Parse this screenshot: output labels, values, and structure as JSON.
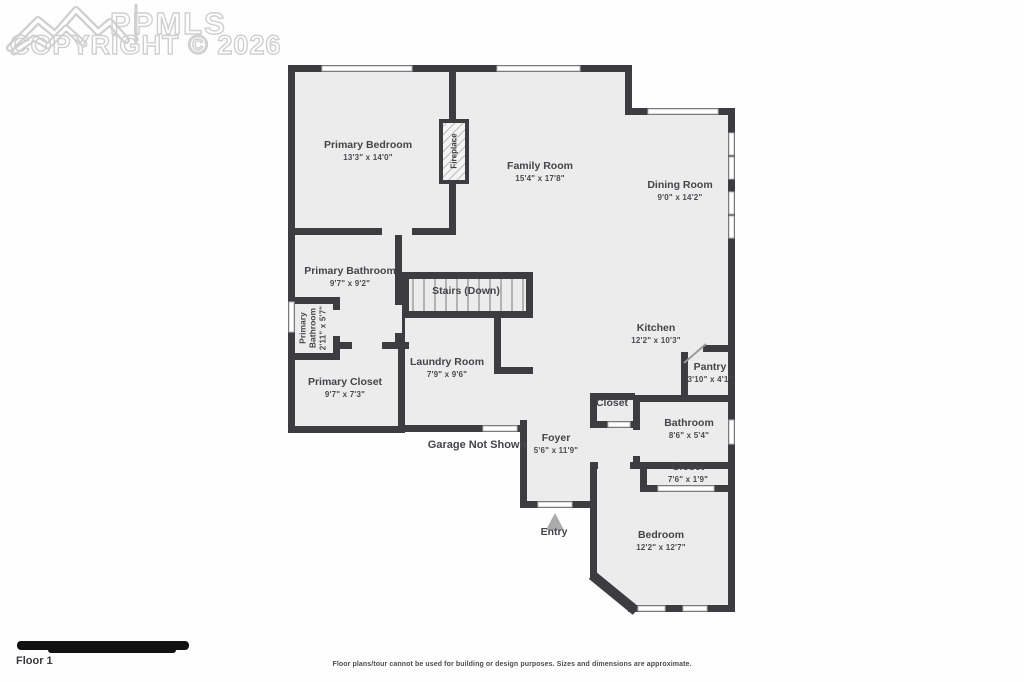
{
  "watermark": {
    "brand": "PPMLS",
    "copyright": "COPYRIGHT © 2026",
    "logo": "mountain-logo"
  },
  "rooms": {
    "primary_bedroom": {
      "name": "Primary Bedroom",
      "dims": "13'3\" x 14'0\""
    },
    "family_room": {
      "name": "Family Room",
      "dims": "15'4\" x 17'8\""
    },
    "dining_room": {
      "name": "Dining Room",
      "dims": "9'0\" x 14'2\""
    },
    "primary_bathroom": {
      "name": "Primary Bathroom",
      "dims": "9'7\" x 9'2\""
    },
    "primary_bathroom_small": {
      "name": "Primary Bathroom",
      "dims": "2'11\" x 5'7\""
    },
    "stairs": {
      "name": "Stairs (Down)"
    },
    "laundry_room": {
      "name": "Laundry Room",
      "dims": "7'9\" x 9'6\""
    },
    "primary_closet": {
      "name": "Primary Closet",
      "dims": "9'7\" x 7'3\""
    },
    "kitchen": {
      "name": "Kitchen",
      "dims": "12'2\" x 10'3\""
    },
    "pantry": {
      "name": "Pantry",
      "dims": "3'10\" x 4'1\""
    },
    "closet_foyer": {
      "name": "Closet"
    },
    "bathroom": {
      "name": "Bathroom",
      "dims": "8'6\" x 5'4\""
    },
    "foyer": {
      "name": "Foyer",
      "dims": "5'6\" x 11'9\""
    },
    "closet_bedroom": {
      "name": "Closet",
      "dims": "7'6\" x 1'9\""
    },
    "bedroom": {
      "name": "Bedroom",
      "dims": "12'2\" x 12'7\""
    },
    "fireplace": {
      "name": "Fireplace"
    }
  },
  "annotations": {
    "garage_note": "Garage Not Shown",
    "entry_label": "Entry"
  },
  "footer": {
    "floor_label": "Floor 1",
    "disclaimer": "Floor plans/tour cannot be used for building or design purposes. Sizes and dimensions are approximate."
  },
  "colors": {
    "wall": "#3d3d41",
    "room_fill": "#ececec",
    "window_border": "#b9b9b9",
    "watermark": "#cfcfcf",
    "entry_arrow": "#ababab",
    "label_text": "#44444a"
  }
}
